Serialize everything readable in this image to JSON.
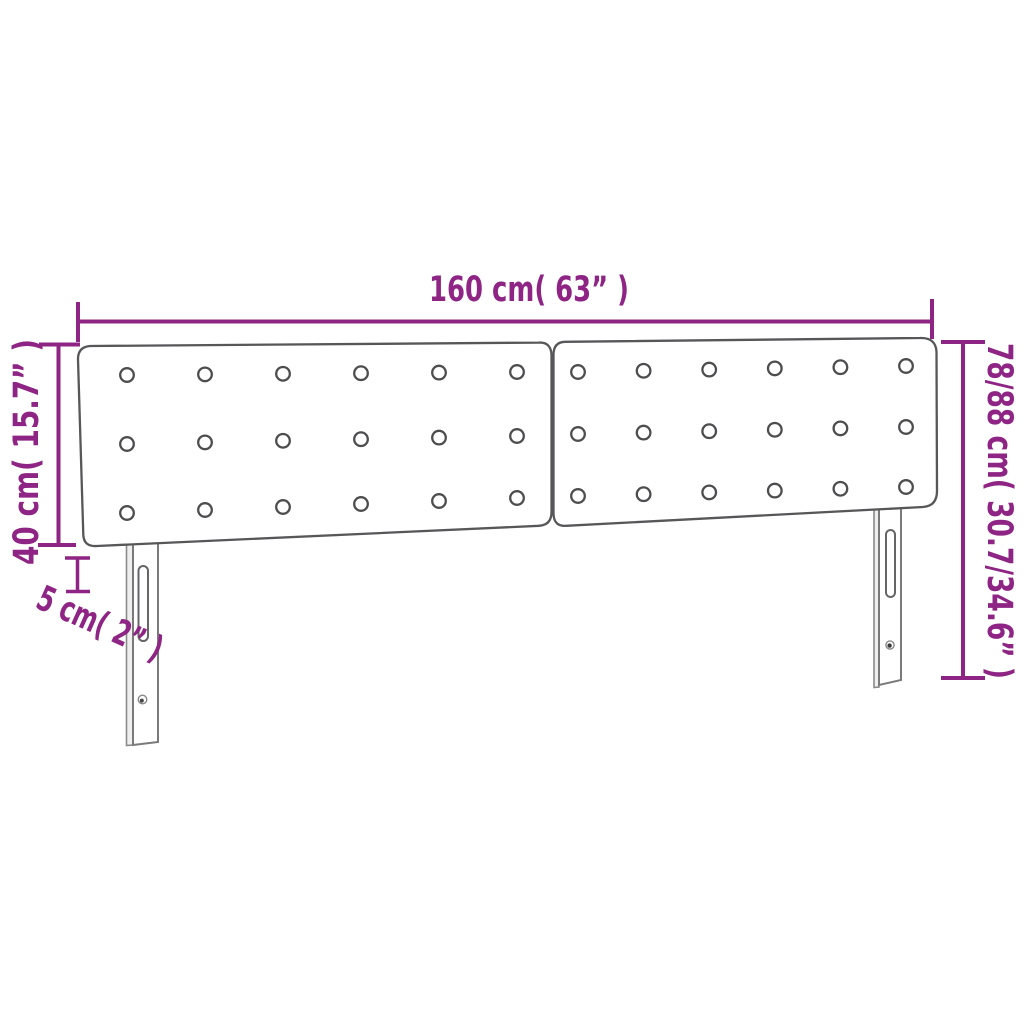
{
  "title": "Headboard dimension diagram",
  "colors": {
    "dimension": "#8E2484",
    "panel_outline": "#57575A",
    "button_outline": "#4D4D4F",
    "leg_outline": "#7A7A7A",
    "leg_side_fill": "#EFEFEF",
    "background": "#FFFFFF"
  },
  "dimensions": {
    "width_label": "160 cm( 63” )",
    "height_range_label": "78/88 cm( 30.7/34.6” )",
    "panel_height_label": "40 cm( 15.7” )",
    "thickness_label": "5 cm( 2” )"
  },
  "structure": {
    "panel_count": 2,
    "button_rows_per_panel": 3,
    "button_cols_per_panel": 6,
    "leg_count": 2
  }
}
